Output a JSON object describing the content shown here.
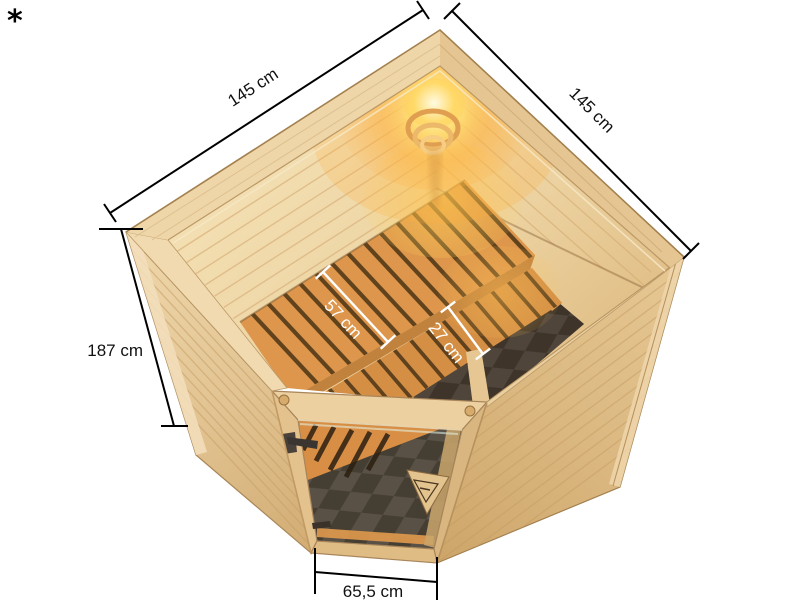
{
  "page": {
    "background": "#ffffff",
    "footnote_marker": "*"
  },
  "figure": {
    "subject": "Corner sauna 3D product render, bird's-eye view, with glass door, two interior benches and a glowing corner lamp",
    "dimensions": {
      "top_left_width": "145 cm",
      "top_right_width": "145 cm",
      "height": "187 cm",
      "upper_bench_depth": "57 cm",
      "lower_bench_depth": "27 cm",
      "door_width": "65,5 cm"
    },
    "colors": {
      "outline_dimension": "#111111",
      "bench_dimension": "#ffffff",
      "wood_light": "#eed5a6",
      "wood_medium": "#dcb983",
      "wood_dark": "#cfa76a",
      "bench_wood": "#e09a4f",
      "bench_gap": "#523818",
      "lamp_glow": "#ffd968",
      "floor_tile_dark": "#55483d",
      "floor_tile_light": "#6f6156",
      "door_handle": "#3a3531"
    }
  }
}
